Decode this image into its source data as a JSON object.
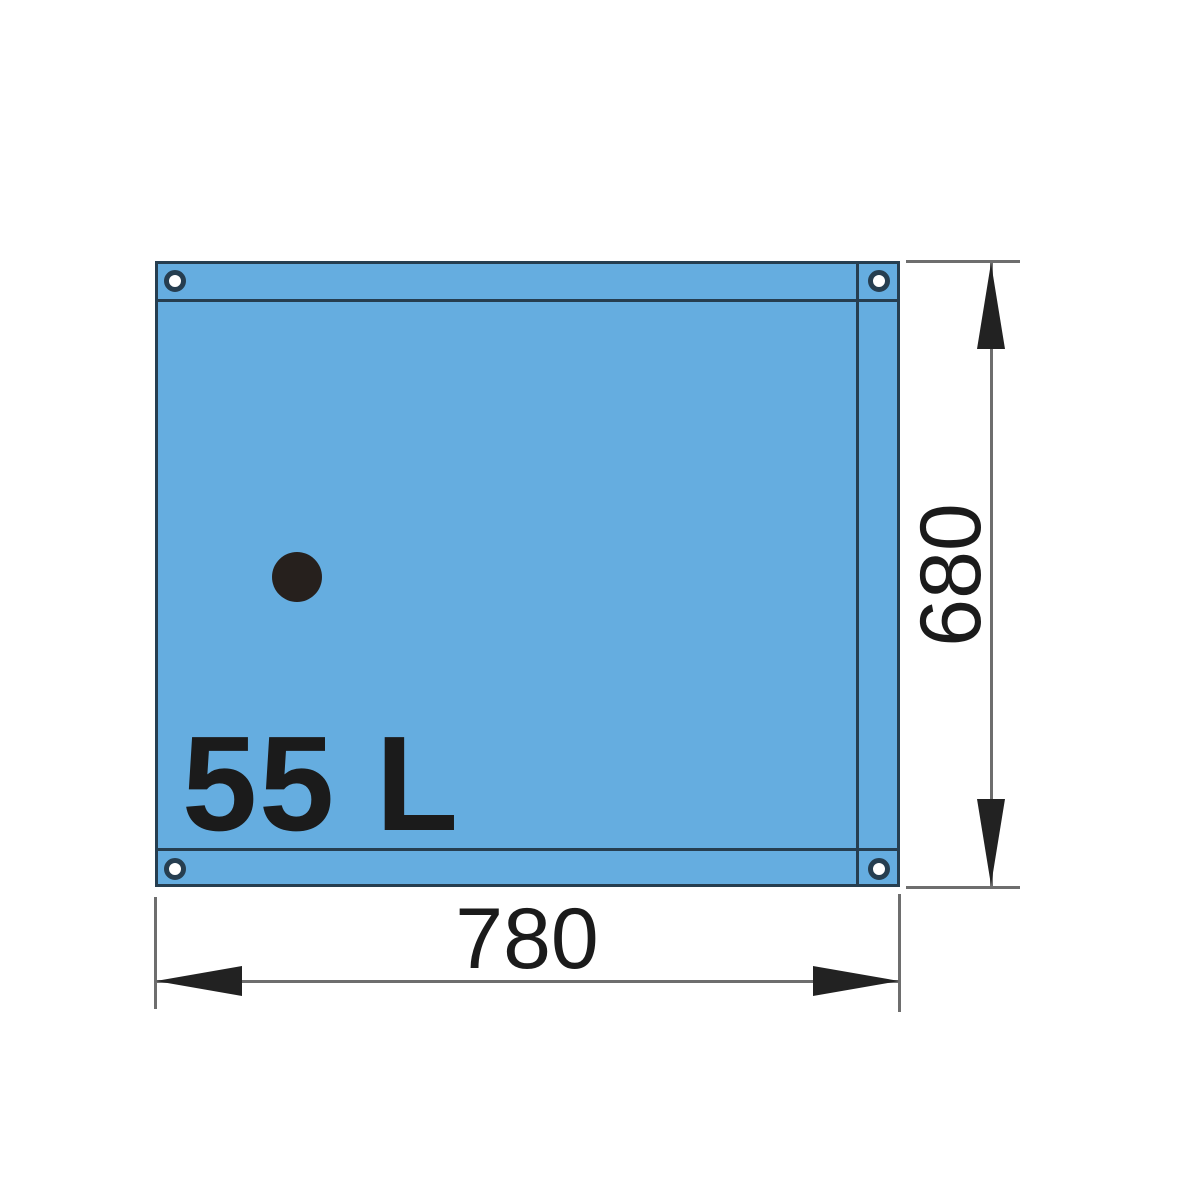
{
  "diagram": {
    "labels": {
      "capacity": "55 L",
      "width_dimension": "780",
      "height_dimension": "680"
    },
    "colors": {
      "page-background": "#ffffff",
      "tank-fill": "#65ade0",
      "tank-outline": "#263e50",
      "dimension-line": "#6e6e6e",
      "arrow": "#222222",
      "label-text": "#1b1b1b",
      "grommet-inner": "#ffffff",
      "fitting-dot": "#26201d"
    },
    "icons": {
      "grommet-icon": "white circle with dark ring (eyelet), one in each corner",
      "fitting-dot-icon": "solid dark filled circle",
      "arrowhead-icon": "elongated filled triangle on dimension line ends"
    }
  }
}
